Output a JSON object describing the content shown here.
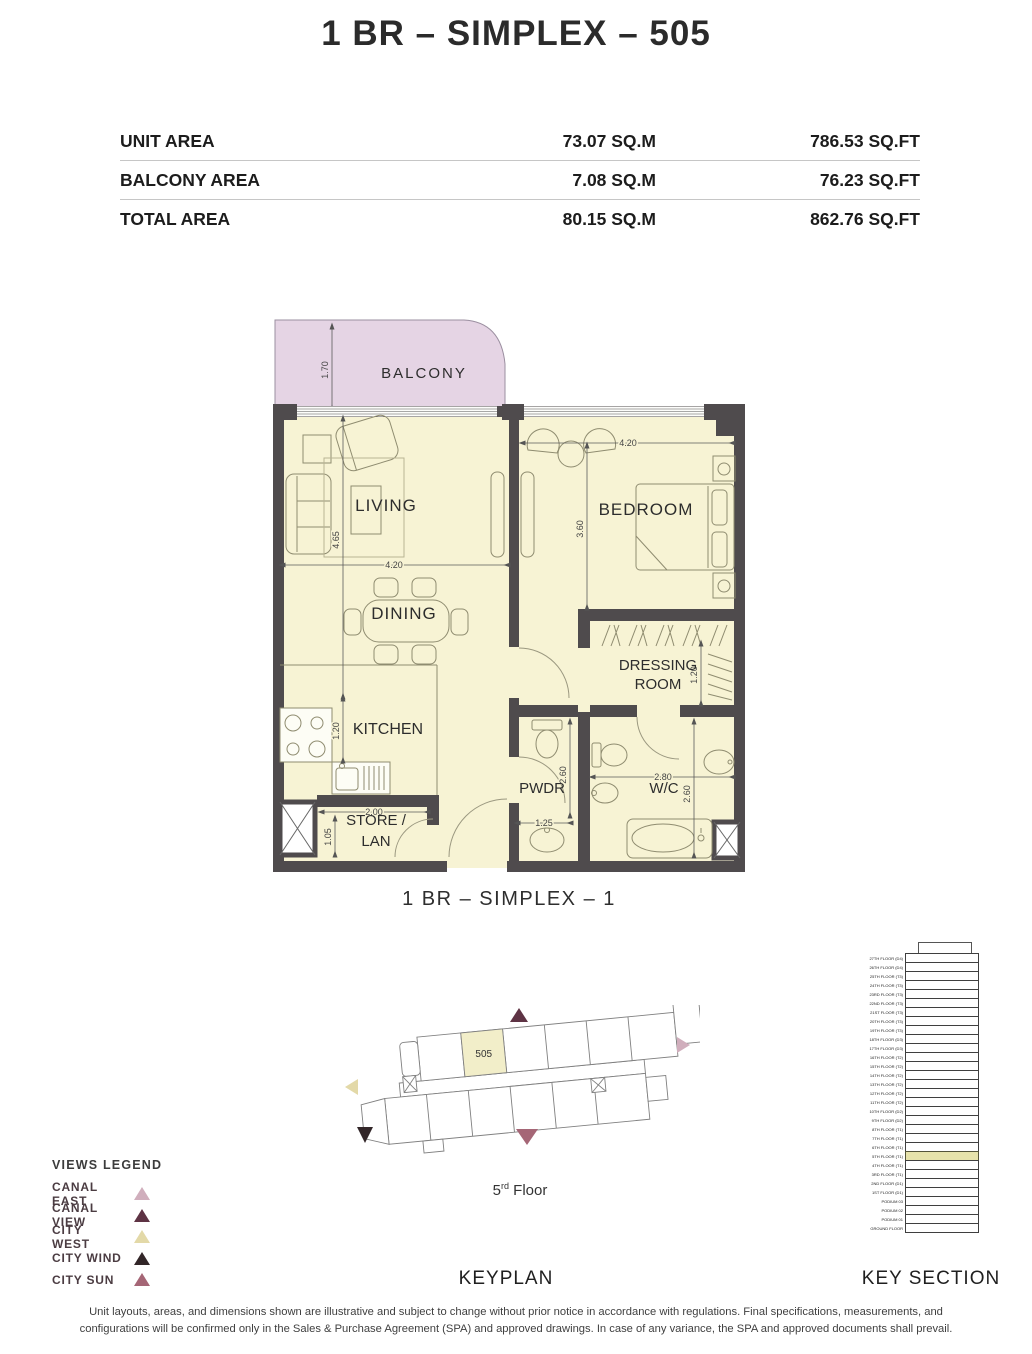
{
  "title": "1 BR – SIMPLEX – 505",
  "area_table": {
    "rows": [
      {
        "label": "UNIT AREA",
        "sqm": "73.07 SQ.M",
        "sqft": "786.53 SQ.FT"
      },
      {
        "label": "BALCONY AREA",
        "sqm": "7.08 SQ.M",
        "sqft": "76.23 SQ.FT"
      },
      {
        "label": "TOTAL AREA",
        "sqm": "80.15 SQ.M",
        "sqft": "862.76 SQ.FT"
      }
    ]
  },
  "floor_plan": {
    "caption": "1 BR – SIMPLEX – 1",
    "rooms": {
      "balcony": "BALCONY",
      "living": "LIVING",
      "bedroom": "BEDROOM",
      "dining": "DINING",
      "dressing_line1": "DRESSING",
      "dressing_line2": "ROOM",
      "kitchen": "KITCHEN",
      "pwdr": "PWDR",
      "wc": "W/C",
      "store_line1": "STORE /",
      "store_line2": "LAN"
    },
    "dims": {
      "balcony_depth": "1.70",
      "living_height": "4.65",
      "living_width": "4.20",
      "bedroom_width": "4.20",
      "bedroom_height": "3.60",
      "dressing_depth": "1.20",
      "kitchen_depth": "1.20",
      "store_width": "2.00",
      "store_height": "1.05",
      "pwdr_width": "1.25",
      "pwdr_height": "2.60",
      "wc_width": "2.80",
      "wc_height": "2.60"
    },
    "colors": {
      "room_fill": "#f7f3d4",
      "balcony_fill": "#e5d4e4",
      "wall": "#4f4b4d",
      "unit_highlight": "#f2eec9"
    }
  },
  "keyplan": {
    "label": "KEYPLAN",
    "unit_number": "505",
    "floor_num": "5",
    "floor_sup": "rd",
    "floor_word": "Floor"
  },
  "key_section": {
    "label": "KEY SECTION",
    "highlight_color": "#e7e3ab",
    "floors": [
      {
        "label": "27TH FLOOR (D4)",
        "highlight": false
      },
      {
        "label": "26TH FLOOR (D4)",
        "highlight": false
      },
      {
        "label": "25TH FLOOR (T3)",
        "highlight": false
      },
      {
        "label": "24TH FLOOR (T3)",
        "highlight": false
      },
      {
        "label": "23RD FLOOR (T3)",
        "highlight": false
      },
      {
        "label": "22ND FLOOR (T3)",
        "highlight": false
      },
      {
        "label": "21ST FLOOR (T3)",
        "highlight": false
      },
      {
        "label": "20TH FLOOR (T3)",
        "highlight": false
      },
      {
        "label": "19TH FLOOR (T3)",
        "highlight": false
      },
      {
        "label": "18TH FLOOR (D3)",
        "highlight": false
      },
      {
        "label": "17TH FLOOR (D3)",
        "highlight": false
      },
      {
        "label": "16TH FLOOR (T2)",
        "highlight": false
      },
      {
        "label": "15TH FLOOR (T2)",
        "highlight": false
      },
      {
        "label": "14TH FLOOR (T2)",
        "highlight": false
      },
      {
        "label": "13TH FLOOR (T2)",
        "highlight": false
      },
      {
        "label": "12TH FLOOR (T2)",
        "highlight": false
      },
      {
        "label": "11TH FLOOR (T2)",
        "highlight": false
      },
      {
        "label": "10TH FLOOR (D2)",
        "highlight": false
      },
      {
        "label": "9TH FLOOR (D2)",
        "highlight": false
      },
      {
        "label": "8TH FLOOR (T1)",
        "highlight": false
      },
      {
        "label": "7TH FLOOR (T1)",
        "highlight": false
      },
      {
        "label": "6TH FLOOR (T1)",
        "highlight": false
      },
      {
        "label": "5TH FLOOR (T1)",
        "highlight": true
      },
      {
        "label": "4TH FLOOR (T1)",
        "highlight": false
      },
      {
        "label": "3RD FLOOR (T1)",
        "highlight": false
      },
      {
        "label": "2ND FLOOR (D1)",
        "highlight": false
      },
      {
        "label": "1ST FLOOR (D1)",
        "highlight": false
      },
      {
        "label": "PODIUM 03",
        "highlight": false
      },
      {
        "label": "PODIUM 02",
        "highlight": false
      },
      {
        "label": "PODIUM 01",
        "highlight": false
      },
      {
        "label": "GROUND FLOOR",
        "highlight": false
      }
    ]
  },
  "views_legend": {
    "heading": "VIEWS LEGEND",
    "items": [
      {
        "label": "CANAL EAST",
        "color": "#d0aebc"
      },
      {
        "label": "CANAL VIEW",
        "color": "#5e3344"
      },
      {
        "label": "CITY WEST",
        "color": "#e3d9a8"
      },
      {
        "label": "CITY WIND",
        "color": "#322628"
      },
      {
        "label": "CITY SUN",
        "color": "#a56676"
      }
    ]
  },
  "disclaimer": {
    "line1": "Unit layouts, areas, and dimensions shown are illustrative and subject to change without prior notice in accordance with regulations. Final specifications, measurements, and",
    "line2": "configurations will be confirmed only in the Sales & Purchase Agreement (SPA) and approved drawings. In case of any variance, the SPA and approved documents shall prevail."
  }
}
